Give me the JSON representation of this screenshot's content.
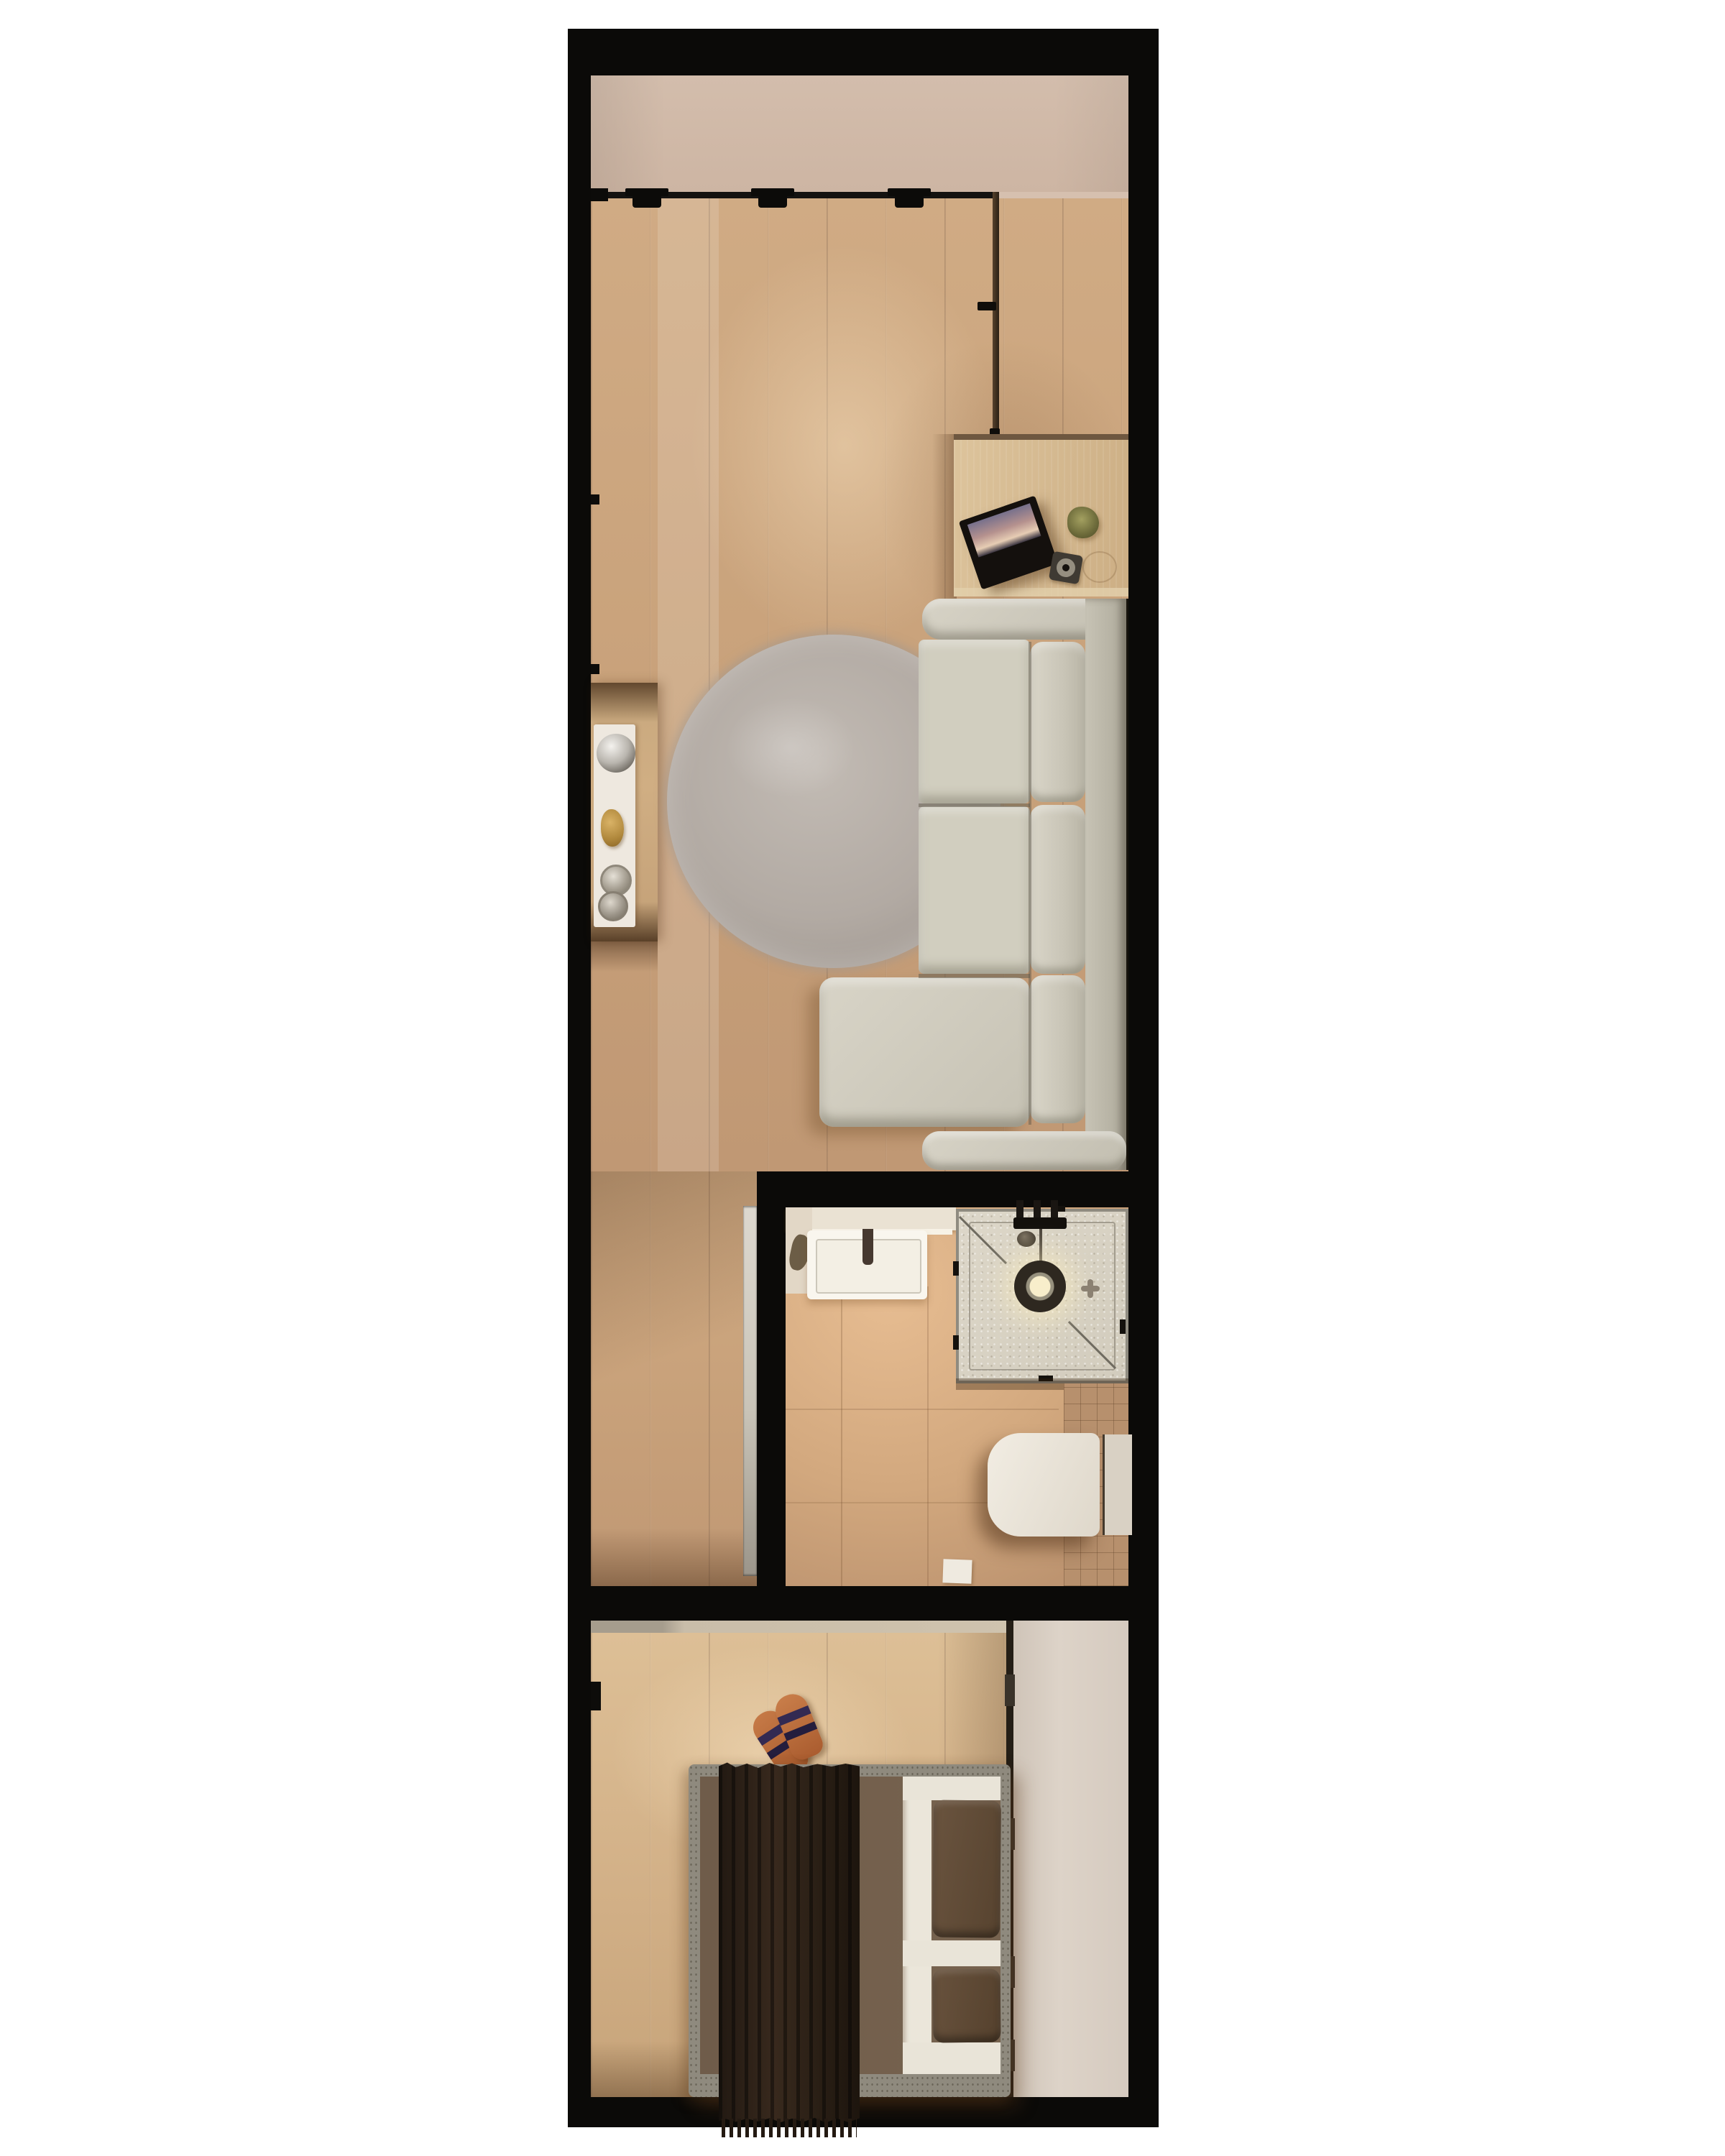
{
  "scene": {
    "title": "Top-down 3D render of a narrow studio apartment floor plan",
    "orientation": "vertical strip plan on white background, thick black walls",
    "rooms": [
      {
        "id": "balcony-zone",
        "label": "Upper plaster zone / balcony strip"
      },
      {
        "id": "living-room",
        "label": "Living room with wood floor"
      },
      {
        "id": "hallway",
        "label": "Hallway strip beside bathroom"
      },
      {
        "id": "bathroom",
        "label": "Bathroom"
      },
      {
        "id": "bedroom",
        "label": "Bedroom with built-in wardrobe"
      }
    ],
    "furniture": {
      "living_room": [
        "sliding glass wall track with three rollers",
        "wall console shelf",
        "white decor runner tray",
        "mirror ball",
        "gold ornament",
        "two glasses",
        "round shaggy rug",
        "wood side table",
        "tilted picture frame",
        "dried plant ball",
        "dark coaster with candle",
        "L-shaped sectional sofa with chaise"
      ],
      "bathroom": [
        "vanity counter",
        "rectangular basin with dark faucet",
        "glass walk-in shower",
        "overhead shower ring with warm light",
        "shower valves and pipe",
        "floor drain rosette",
        "wall-hung toilet",
        "cistern side panel",
        "small floor paper"
      ],
      "bedroom": [
        "double bed with gray frame",
        "taupe mattress",
        "dark fringed throw blanket",
        "white folded sheet",
        "two brown pillows",
        "pair of tan slippers",
        "full-height beige wardrobe with hinges",
        "pocket sliding door leaf"
      ]
    },
    "palette": {
      "page_background": "#ffffff",
      "walls": "#0b0a08",
      "plaster_beige": "#d0b8a7",
      "wood_living": "#c9a27c",
      "wood_bedroom": "#d4b289",
      "rug_gray": "#b2aaa3",
      "sofa_fabric": "#d1cebf",
      "side_table_oak": "#d5bc93",
      "bathroom_tile": "#d2a87e",
      "bathroom_dark_tile": "#b7906d",
      "shower_tray": "#d9d3c5",
      "sanitary_white": "#f3efe5",
      "bed_throw": "#281e15",
      "bed_pillow_brown": "#5f4b3a",
      "wardrobe_beige": "#d7ccc1",
      "slipper_tan": "#b96a3c",
      "shower_light_glow": "#f8eecb"
    }
  }
}
